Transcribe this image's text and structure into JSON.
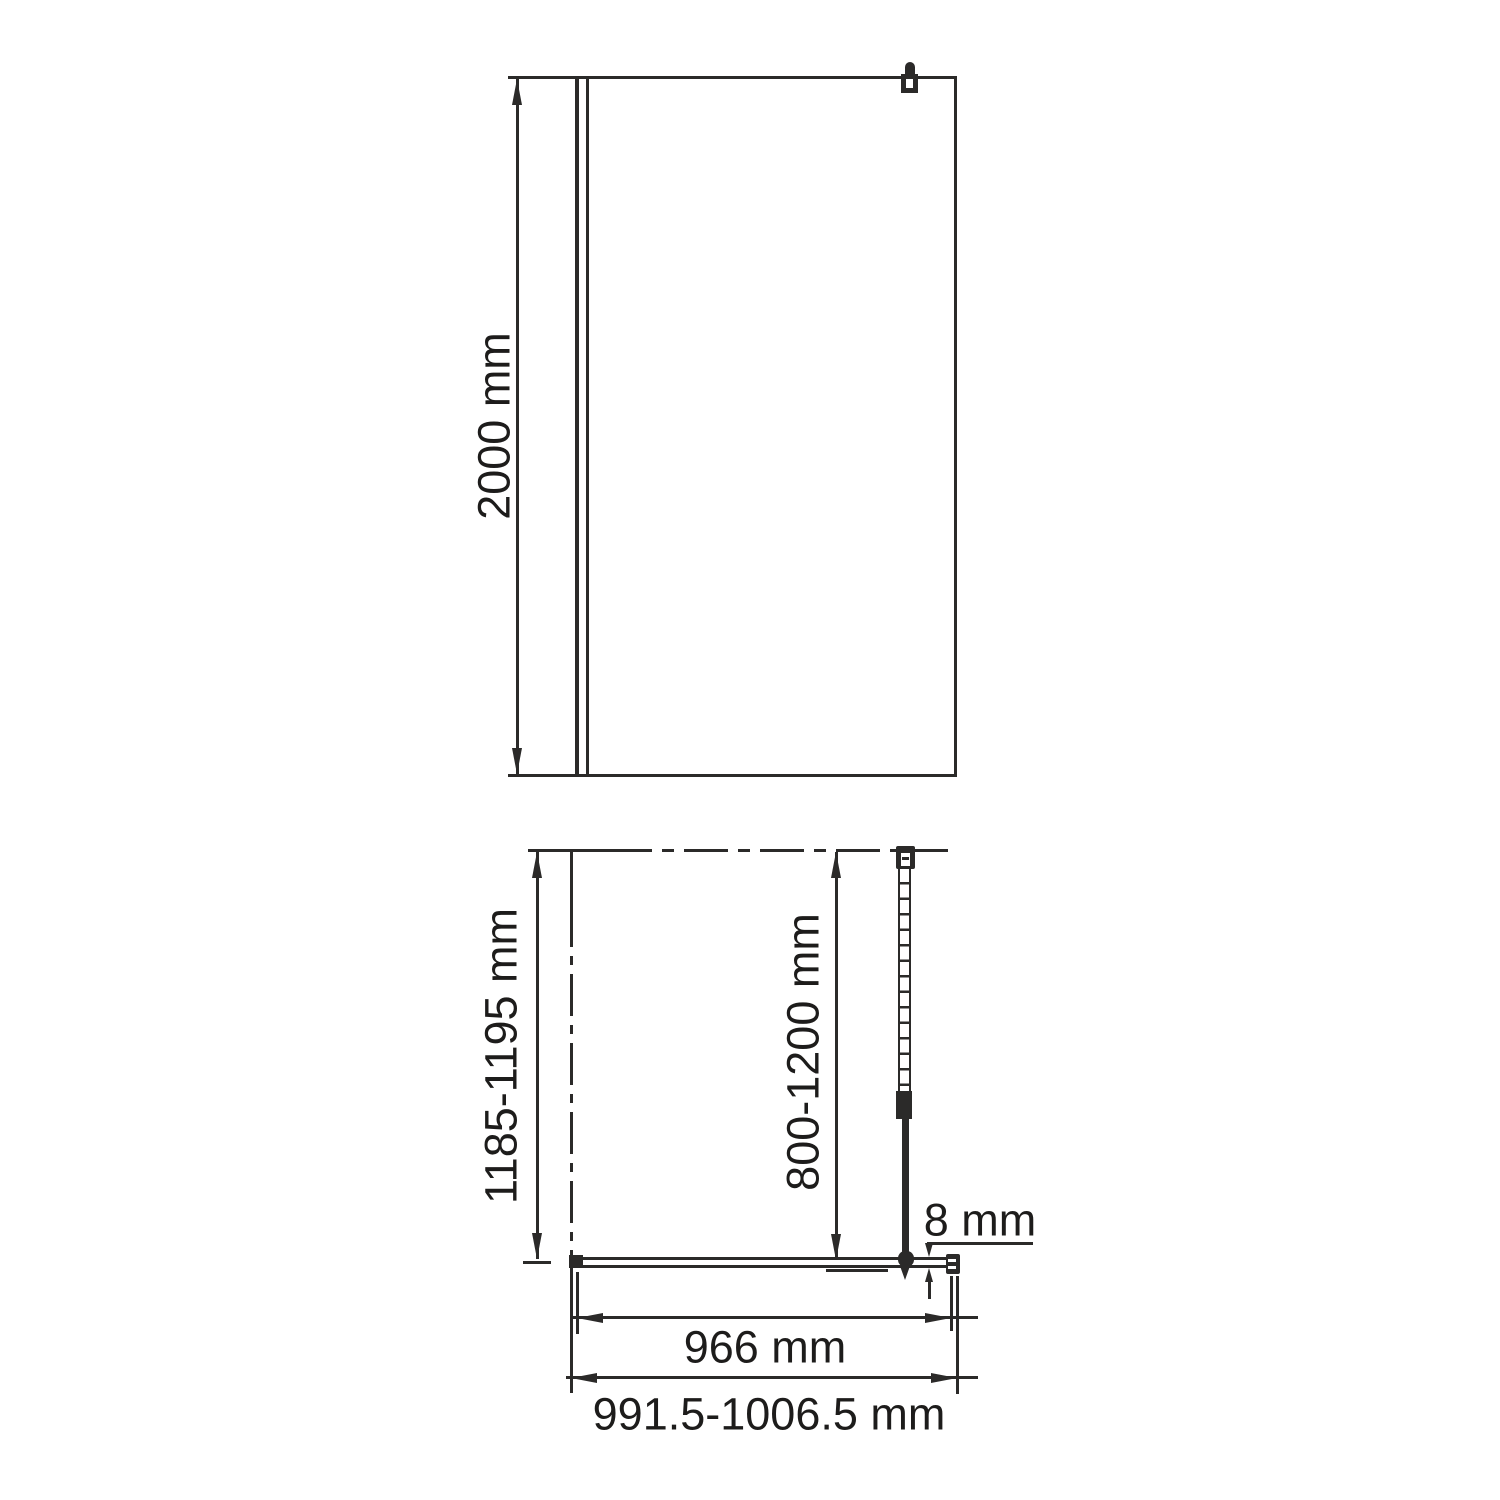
{
  "colors": {
    "ink": "#2b2a29",
    "paper": "#ffffff"
  },
  "front_view": {
    "height_label": "2000 mm"
  },
  "plan_view": {
    "depth_label": "1185-1195 mm",
    "support_arm_label": "800-1200 mm",
    "glass_thickness_label": "8 mm",
    "glass_width_label": "966 mm",
    "overall_width_label": "991.5-1006.5 mm"
  }
}
